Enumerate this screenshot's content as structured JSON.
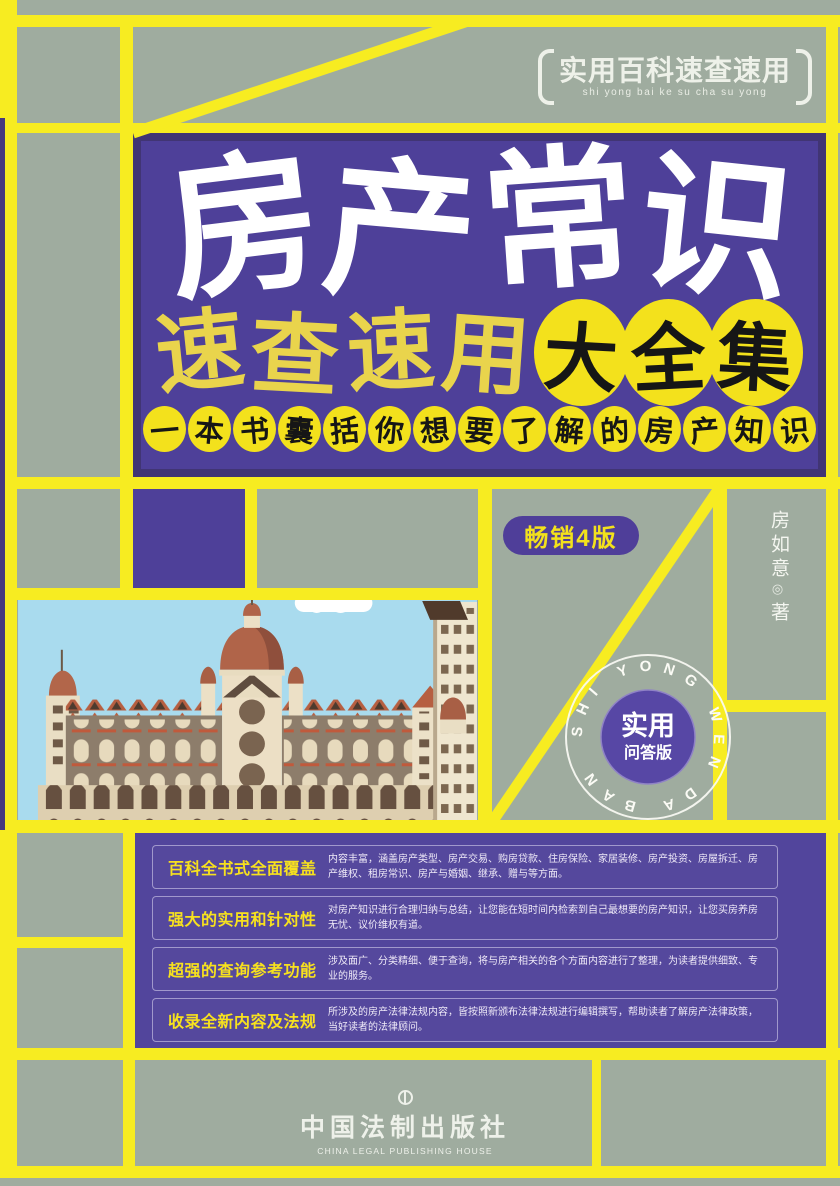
{
  "series_badge": {
    "title": "实用百科速查速用",
    "pinyin": "shi yong bai ke su cha su yong"
  },
  "title": {
    "chars": [
      "房",
      "产",
      "常",
      "识"
    ]
  },
  "subtitle": {
    "plain_chars": [
      "速",
      "查",
      "速",
      "用"
    ],
    "circled_chars": [
      "大",
      "全",
      "集"
    ]
  },
  "tagline_chars": [
    "一",
    "本",
    "书",
    "囊",
    "括",
    "你",
    "想",
    "要",
    "了",
    "解",
    "的",
    "房",
    "产",
    "知",
    "识"
  ],
  "edition_badge": "畅销4版",
  "author": {
    "name": "房如意",
    "separator": "◎",
    "role": "著"
  },
  "seal": {
    "ring_text": "SHI YONG WEN DA BAN",
    "line1": "实用",
    "line2": "问答版"
  },
  "features": [
    {
      "label": "百科全书式全面覆盖",
      "desc": "内容丰富，涵盖房产类型、房产交易、购房贷款、住房保险、家居装修、房产投资、房屋拆迁、房产维权、租房常识、房产与婚姻、继承、赠与等方面。"
    },
    {
      "label": "强大的实用和针对性",
      "desc": "对房产知识进行合理归纳与总结，让您能在短时间内检索到自己最想要的房产知识，让您买房养房无忧、议价维权有道。"
    },
    {
      "label": "超强的查询参考功能",
      "desc": "涉及面广、分类精细、便于查询，将与房产相关的各个方面内容进行了整理，为读者提供细致、专业的服务。"
    },
    {
      "label": "收录全新内容及法规",
      "desc": "所涉及的房产法律法规内容，皆按照新颁布法律法规进行编辑撰写，帮助读者了解房产法律政策，当好读者的法律顾问。"
    }
  ],
  "publisher": {
    "name_cn": "中国法制出版社",
    "name_en": "CHINA LEGAL PUBLISHING HOUSE"
  },
  "colors": {
    "background_sage": "#9fac9f",
    "grid_yellow": "#f7ec21",
    "title_purple": "#4e4099",
    "panel_purple": "#52459c",
    "circle_yellow": "#f3e11c",
    "sky_blue": "#a9dbee",
    "label_yellow": "#f7e11e"
  }
}
